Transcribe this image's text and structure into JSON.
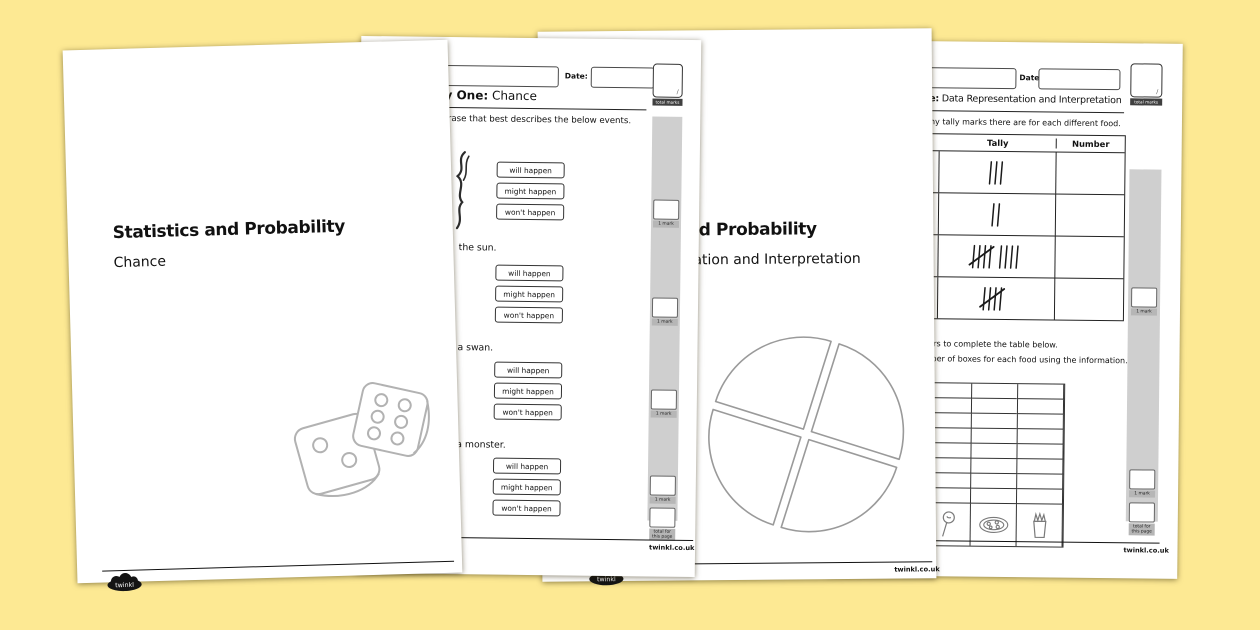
{
  "background_color": "#fde993",
  "brand": {
    "logo_text": "twinkl",
    "website_text": "twinkl.co.uk"
  },
  "page1": {
    "title": "Statistics and Probability",
    "subtitle": "Chance"
  },
  "page2": {
    "date_label": "Date:",
    "heading_bold": "Activity One:",
    "heading_rest": " Chance",
    "instruction": "Tick the phrase that best describes the below events.",
    "events": [
      {
        "label": ""
      },
      {
        "label": "the sun."
      },
      {
        "label": "a swan."
      },
      {
        "label": "a monster."
      }
    ],
    "options": [
      "will happen",
      "might happen",
      "won't happen"
    ],
    "total_marks_value": "/",
    "total_marks_label": "total marks",
    "mark_label": "1 mark",
    "page_total_label": "total for this page"
  },
  "page3": {
    "title": "Statistics and Probability",
    "subtitle": "Data Representation and Interpretation"
  },
  "page4": {
    "date_label": "Date:",
    "heading_bold": "Activity One:",
    "heading_rest": " Data Representation and Interpretation",
    "instruction1": "Count how many tally marks there are for each different food.",
    "table": {
      "headers": [
        "Tally",
        "Number"
      ],
      "rows": [
        {
          "tally": 3,
          "number": ""
        },
        {
          "tally": 2,
          "number": ""
        },
        {
          "tally": 9,
          "number": ""
        },
        {
          "tally": 5,
          "number": ""
        }
      ]
    },
    "instruction2": "Use your answers to complete the table below.",
    "instruction3": "Colour the number of boxes for each food using the information.",
    "grid": {
      "rows": 8,
      "cols": 4,
      "icons": [
        "toffee-apple",
        "pizza",
        "chips-cup"
      ]
    },
    "total_marks_value": "/",
    "total_marks_label": "total marks",
    "mark_label": "1 mark",
    "page_total_label": "total for this page"
  }
}
